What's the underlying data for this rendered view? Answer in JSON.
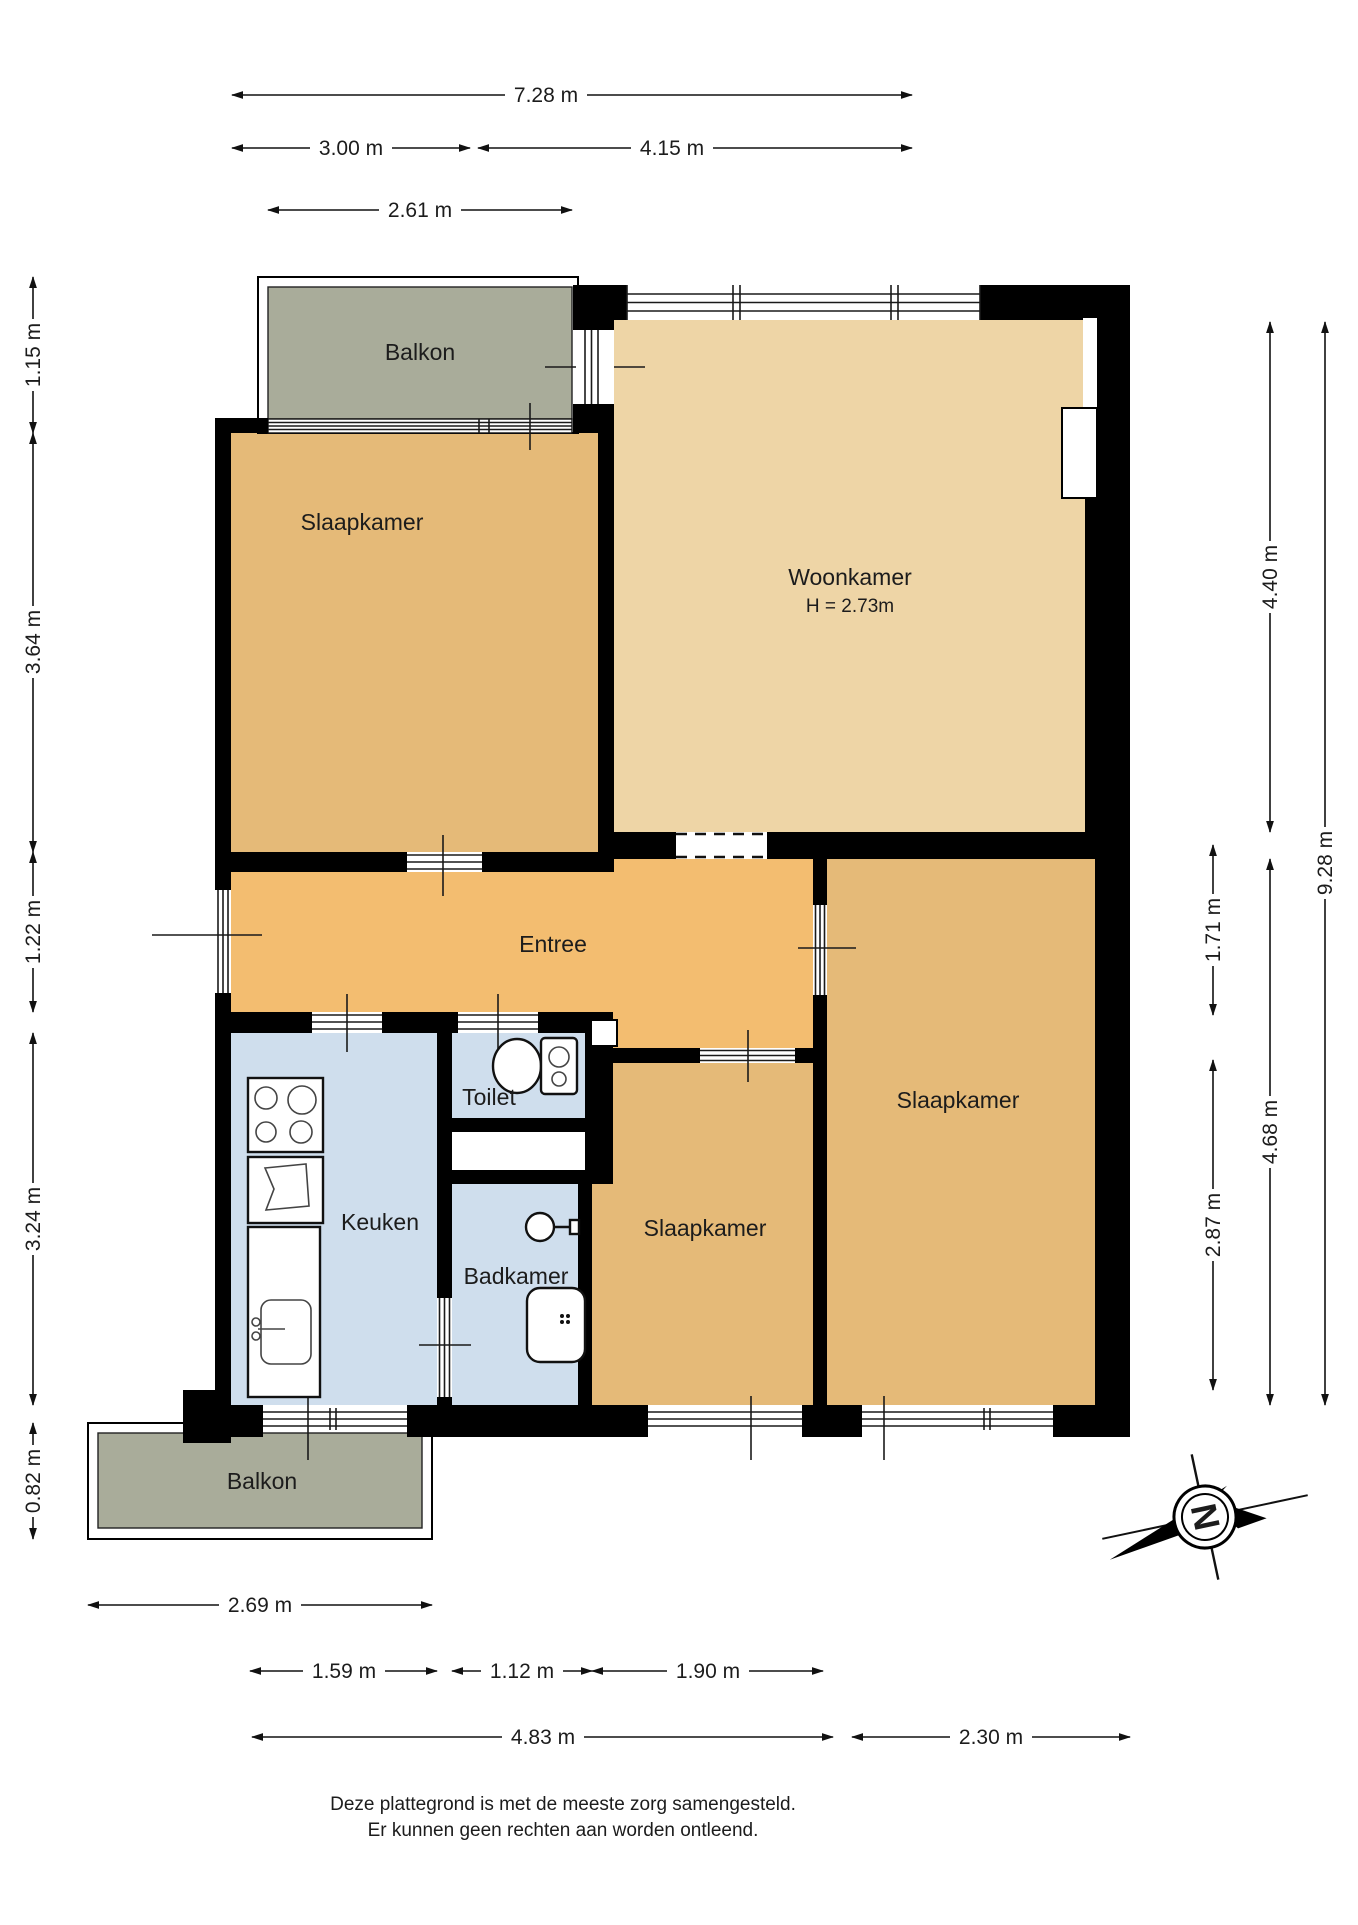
{
  "plan": {
    "rooms": [
      {
        "id": "balkon-top",
        "label": "Balkon"
      },
      {
        "id": "slaapkamer-nw",
        "label": "Slaapkamer"
      },
      {
        "id": "woonkamer",
        "label": "Woonkamer",
        "height_note": "H = 2.73m"
      },
      {
        "id": "entree",
        "label": "Entree"
      },
      {
        "id": "toilet",
        "label": "Toilet"
      },
      {
        "id": "keuken",
        "label": "Keuken"
      },
      {
        "id": "badkamer",
        "label": "Badkamer"
      },
      {
        "id": "slaapkamer-mid",
        "label": "Slaapkamer"
      },
      {
        "id": "slaapkamer-east",
        "label": "Slaapkamer"
      },
      {
        "id": "balkon-bottom",
        "label": "Balkon"
      }
    ],
    "dimensions": {
      "top": [
        "7.28 m",
        "3.00 m",
        "4.15 m",
        "2.61 m"
      ],
      "left": [
        "1.15 m",
        "3.64 m",
        "1.22 m",
        "3.24 m",
        "0.82 m"
      ],
      "right": [
        "4.40 m",
        "1.71 m",
        "4.68 m",
        "2.87 m",
        "9.28 m"
      ],
      "bottom": [
        "2.69 m",
        "1.59 m",
        "1.12 m",
        "1.90 m",
        "4.83 m",
        "2.30 m"
      ]
    },
    "compass": {
      "north_label": "N"
    },
    "footer": {
      "line1": "Deze plattegrond is met de meeste zorg samengesteld.",
      "line2": "Er kunnen geen rechten aan worden ontleend."
    },
    "colors": {
      "wall": "#000000",
      "bedroom": "#e5ba78",
      "living": "#eed5a6",
      "hall": "#f3bd70",
      "wet": "#cfdeed",
      "balcony": "#a9ac9a"
    }
  }
}
